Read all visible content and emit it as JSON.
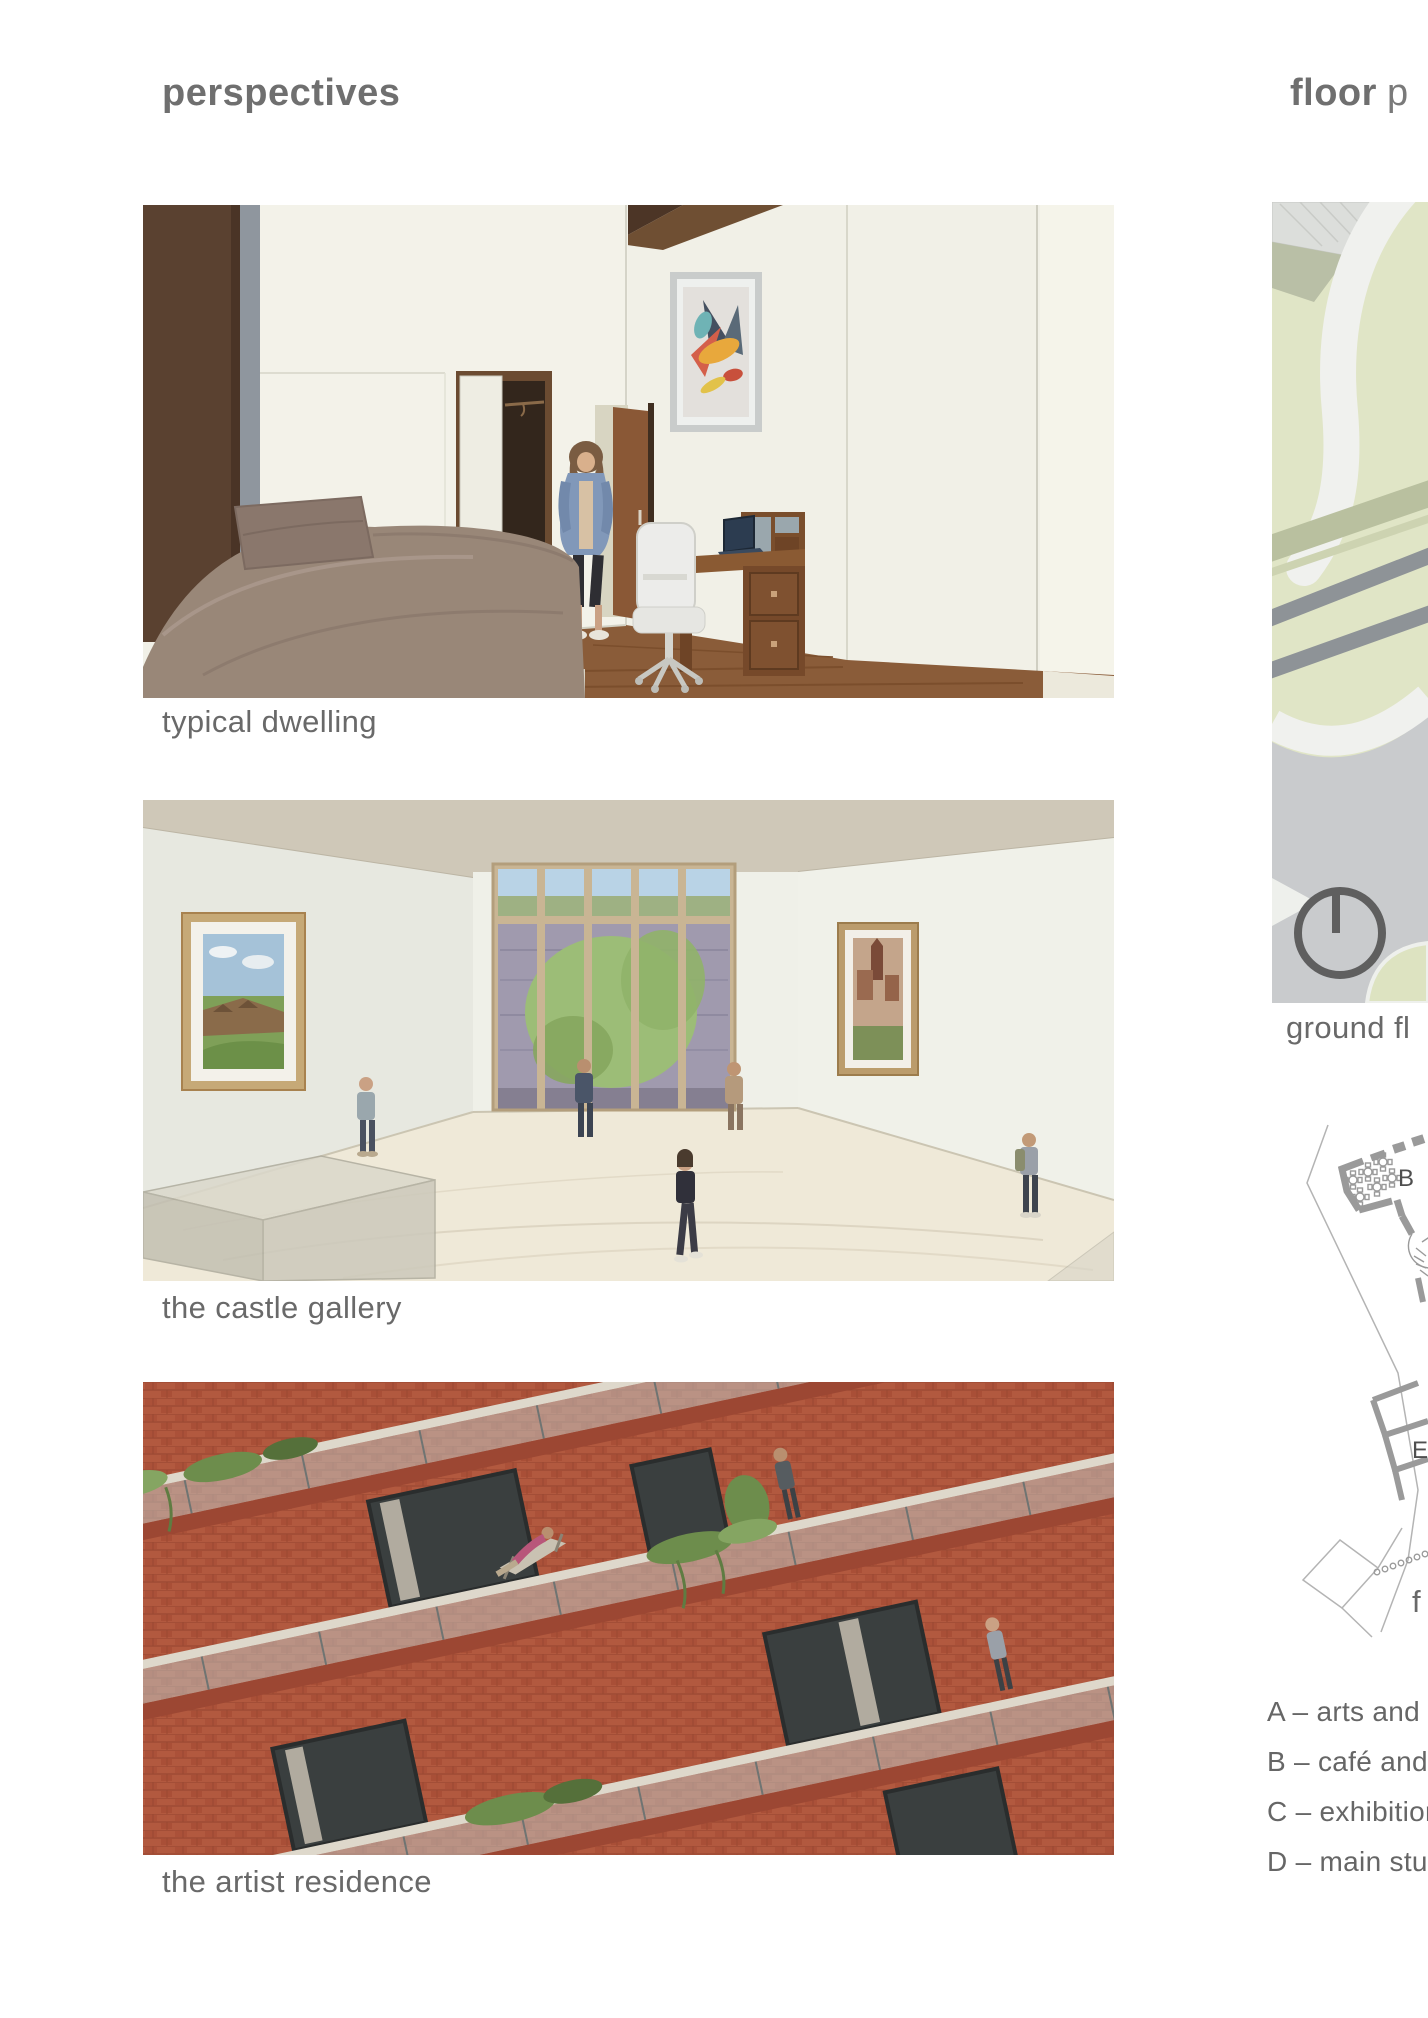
{
  "left": {
    "title": "perspectives",
    "items": [
      {
        "caption": "typical dwelling"
      },
      {
        "caption": "the castle gallery"
      },
      {
        "caption": "the artist residence"
      }
    ]
  },
  "right": {
    "title_bold": "floor",
    "title_rest": "p",
    "ground_caption": "ground fl",
    "first_caption": "f",
    "plan_letters": {
      "cafe": "B",
      "lower": "E"
    },
    "legend": [
      "A – arts and cr",
      "B – café and re",
      "C – exhibition s",
      "D – main studi"
    ]
  },
  "icons": {
    "north_arrow": "north-arrow-icon (circle with line to 12 o'clock)"
  },
  "colors": {
    "title_gray": "#6f6f6f",
    "caption_gray": "#696969",
    "legend_gray": "#666666",
    "brick_red": "#b2593f",
    "terracotta": "#9c4733",
    "lawn_green": "#dfe4c4",
    "olive_band": "#b9bfa6",
    "path_white": "#f0f1ee",
    "plaza_gray": "#c9cbcd",
    "plan_wall_gray": "#9a9a9a",
    "wood_brown": "#8a5c39",
    "wall_cream": "#f1f0e7"
  }
}
